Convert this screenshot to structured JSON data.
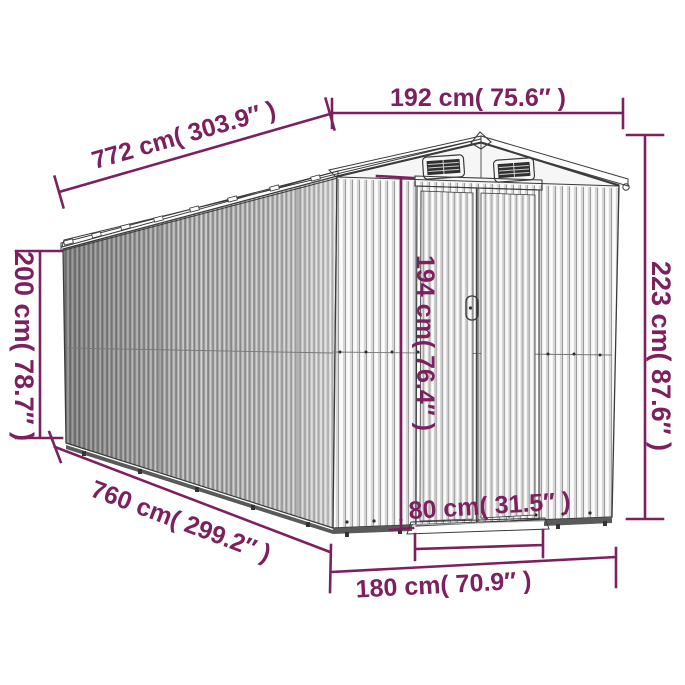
{
  "page": {
    "background": "#ffffff"
  },
  "colors": {
    "dimension": "#7d205f",
    "outline": "#3a3a3a",
    "wall_front": "#f3f3f3",
    "wall_side": "#b9b9b9",
    "vent_dark": "#2f2f2f"
  },
  "diagram": {
    "subject": "metal garden shed perspective line drawing with dimension annotations",
    "labels": {
      "ridge_length": "772 cm( 303.9″ )",
      "front_width": "192 cm( 75.6″ )",
      "total_height": "223 cm( 87.6″ )",
      "wall_height": "200 cm( 78.7″ )",
      "door_height": "194 cm( 76.4″ )",
      "base_length": "760 cm( 299.2″ )",
      "door_width": "80 cm( 31.5″ )",
      "base_width": "180 cm( 70.9″ )"
    }
  }
}
